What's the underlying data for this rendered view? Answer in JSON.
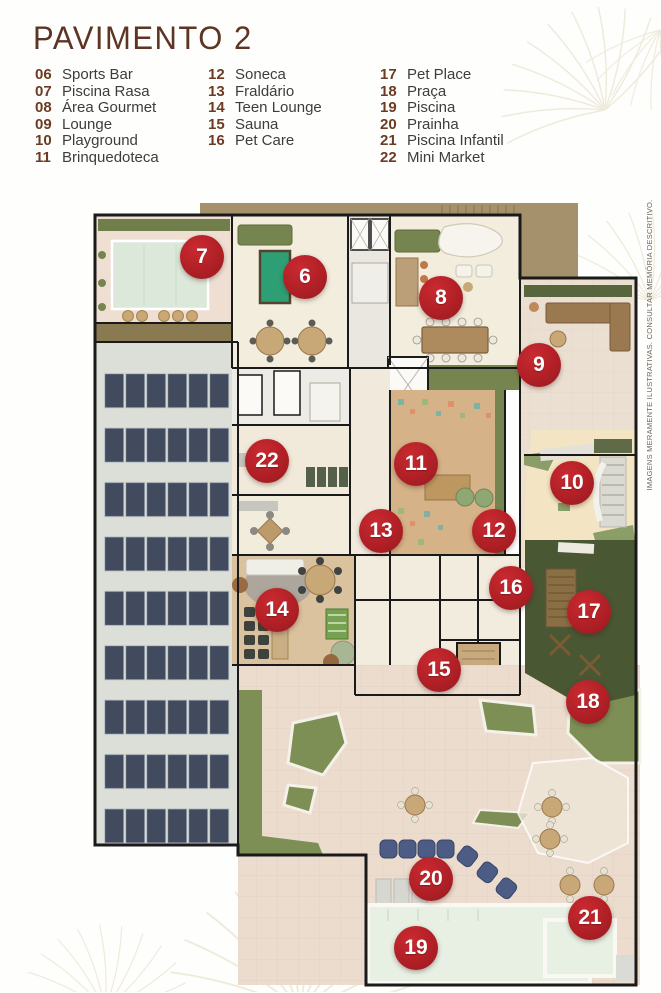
{
  "page": {
    "title": "PAVIMENTO 2",
    "disclaimer": "IMAGENS MERAMENTE ILUSTRATIVAS. CONSULTAR MEMÓRIA DESCRITIVO."
  },
  "legend": {
    "columns": [
      {
        "items": [
          {
            "num": "06",
            "label": "Sports Bar"
          },
          {
            "num": "07",
            "label": "Piscina Rasa"
          },
          {
            "num": "08",
            "label": "Área Gourmet"
          },
          {
            "num": "09",
            "label": "Lounge"
          },
          {
            "num": "10",
            "label": "Playground"
          },
          {
            "num": "11",
            "label": "Brinquedoteca"
          }
        ]
      },
      {
        "items": [
          {
            "num": "12",
            "label": "Soneca"
          },
          {
            "num": "13",
            "label": "Fraldário"
          },
          {
            "num": "14",
            "label": "Teen Lounge"
          },
          {
            "num": "15",
            "label": "Sauna"
          },
          {
            "num": "16",
            "label": "Pet Care"
          }
        ]
      },
      {
        "items": [
          {
            "num": "17",
            "label": "Pet Place"
          },
          {
            "num": "18",
            "label": "Praça"
          },
          {
            "num": "19",
            "label": "Piscina"
          },
          {
            "num": "20",
            "label": "Prainha"
          },
          {
            "num": "21",
            "label": "Piscina Infantil"
          },
          {
            "num": "22",
            "label": "Mini Market"
          }
        ]
      }
    ]
  },
  "floorplan": {
    "markers": [
      {
        "n": "6",
        "x": 305,
        "y": 277
      },
      {
        "n": "7",
        "x": 202,
        "y": 257
      },
      {
        "n": "8",
        "x": 441,
        "y": 298
      },
      {
        "n": "9",
        "x": 539,
        "y": 365
      },
      {
        "n": "10",
        "x": 572,
        "y": 483
      },
      {
        "n": "11",
        "x": 416,
        "y": 464
      },
      {
        "n": "12",
        "x": 494,
        "y": 531
      },
      {
        "n": "13",
        "x": 381,
        "y": 531
      },
      {
        "n": "14",
        "x": 277,
        "y": 610
      },
      {
        "n": "15",
        "x": 439,
        "y": 670
      },
      {
        "n": "16",
        "x": 511,
        "y": 588
      },
      {
        "n": "17",
        "x": 589,
        "y": 612
      },
      {
        "n": "18",
        "x": 588,
        "y": 702
      },
      {
        "n": "19",
        "x": 416,
        "y": 948
      },
      {
        "n": "20",
        "x": 431,
        "y": 879
      },
      {
        "n": "21",
        "x": 590,
        "y": 918
      },
      {
        "n": "22",
        "x": 267,
        "y": 461
      }
    ]
  },
  "colors": {
    "badge_red": "#B02026",
    "title_brown": "#5E3424",
    "legend_number_brown": "#6D3B24",
    "legend_label_gray": "#3D3D3D",
    "tan_band": "#A5926C",
    "lawn_green": "#7D8F55",
    "pet_place_green": "#4A5733",
    "pool_water": "#E7F0E3",
    "solar_panel": "#424B5E"
  }
}
